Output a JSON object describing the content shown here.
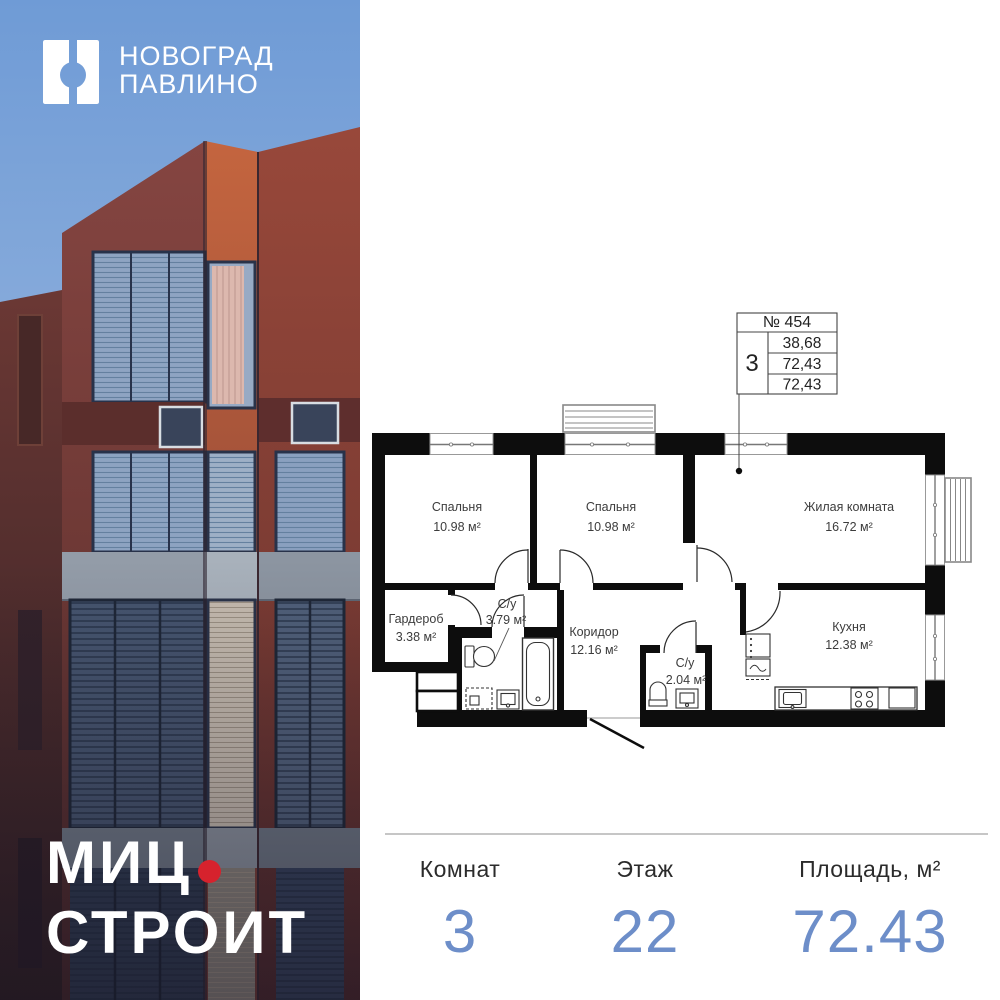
{
  "logo": {
    "line1": "НОВОГРАД",
    "line2": "ПАВЛИНО"
  },
  "brand": {
    "line1": "МИЦ",
    "line2": "СТРОИТ"
  },
  "floor_plan": {
    "unit_table": {
      "number": "№ 454",
      "rooms": "3",
      "areas": [
        "38,68",
        "72,43",
        "72,43"
      ]
    },
    "rooms": [
      {
        "name": "Спальня",
        "area": "10.98 м²"
      },
      {
        "name": "Спальня",
        "area": "10.98 м²"
      },
      {
        "name": "Жилая комната",
        "area": "16.72 м²"
      },
      {
        "name": "Гардероб",
        "area": "3.38 м²"
      },
      {
        "name": "С/у",
        "area": "3.79 м²"
      },
      {
        "name": "Коридор",
        "area": "12.16 м²"
      },
      {
        "name": "С/у",
        "area": "2.04 м²"
      },
      {
        "name": "Кухня",
        "area": "12.38 м²"
      }
    ]
  },
  "stats": [
    {
      "label": "Комнат",
      "value": "3"
    },
    {
      "label": "Этаж",
      "value": "22"
    },
    {
      "label": "Площадь, м²",
      "value": "72.43"
    }
  ],
  "colors": {
    "accent_blue": "#6d8ec9",
    "brand_dot_red": "#d6222d",
    "sky_blue": "#6f9bd6",
    "wall_black": "#0d0d0d"
  }
}
